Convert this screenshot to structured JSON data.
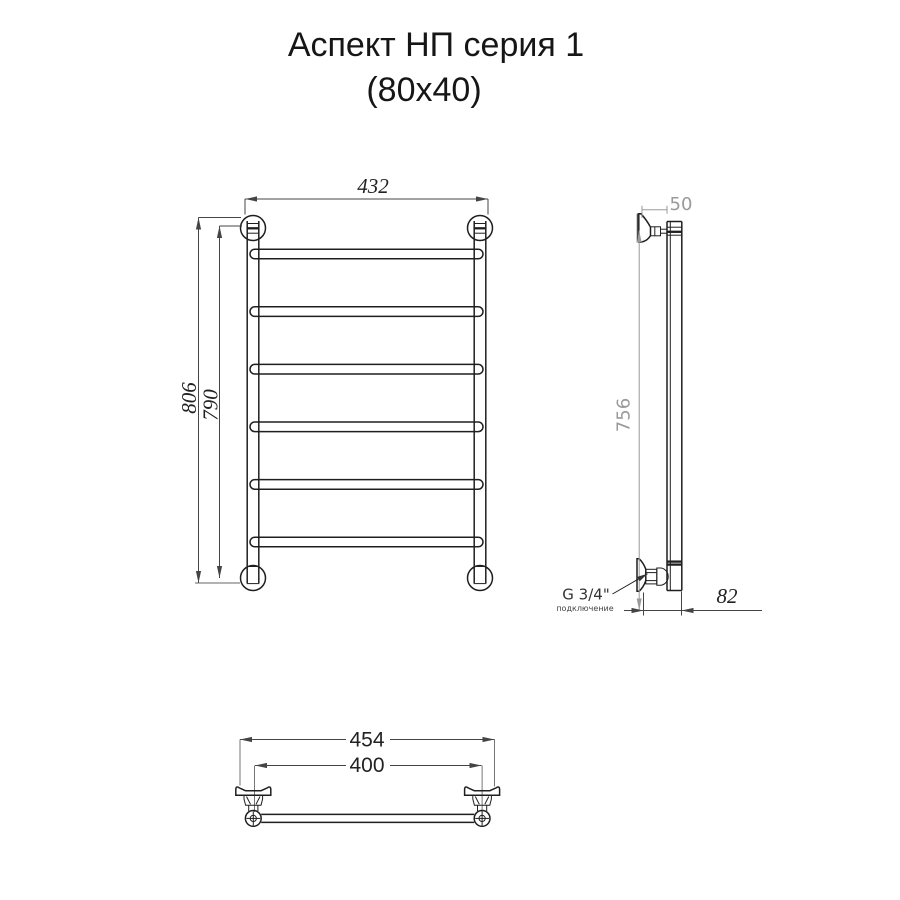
{
  "title": {
    "line1": "Аспект НП серия 1",
    "line2": "(80x40)"
  },
  "front": {
    "dim_width": "432",
    "dim_height_outer": "806",
    "dim_height_inner": "790",
    "rung_count": 6
  },
  "side": {
    "dim_bracket_depth": "50",
    "dim_height": "756",
    "dim_bottom_depth": "82",
    "connection": "G 3/4\"",
    "connection_note": "подключение"
  },
  "plan": {
    "dim_width_outer": "454",
    "dim_width_inner": "400"
  },
  "colors": {
    "line": "#1f1f1f",
    "dim": "#444444",
    "dim_light": "#9a9a9a",
    "bg": "#ffffff"
  }
}
